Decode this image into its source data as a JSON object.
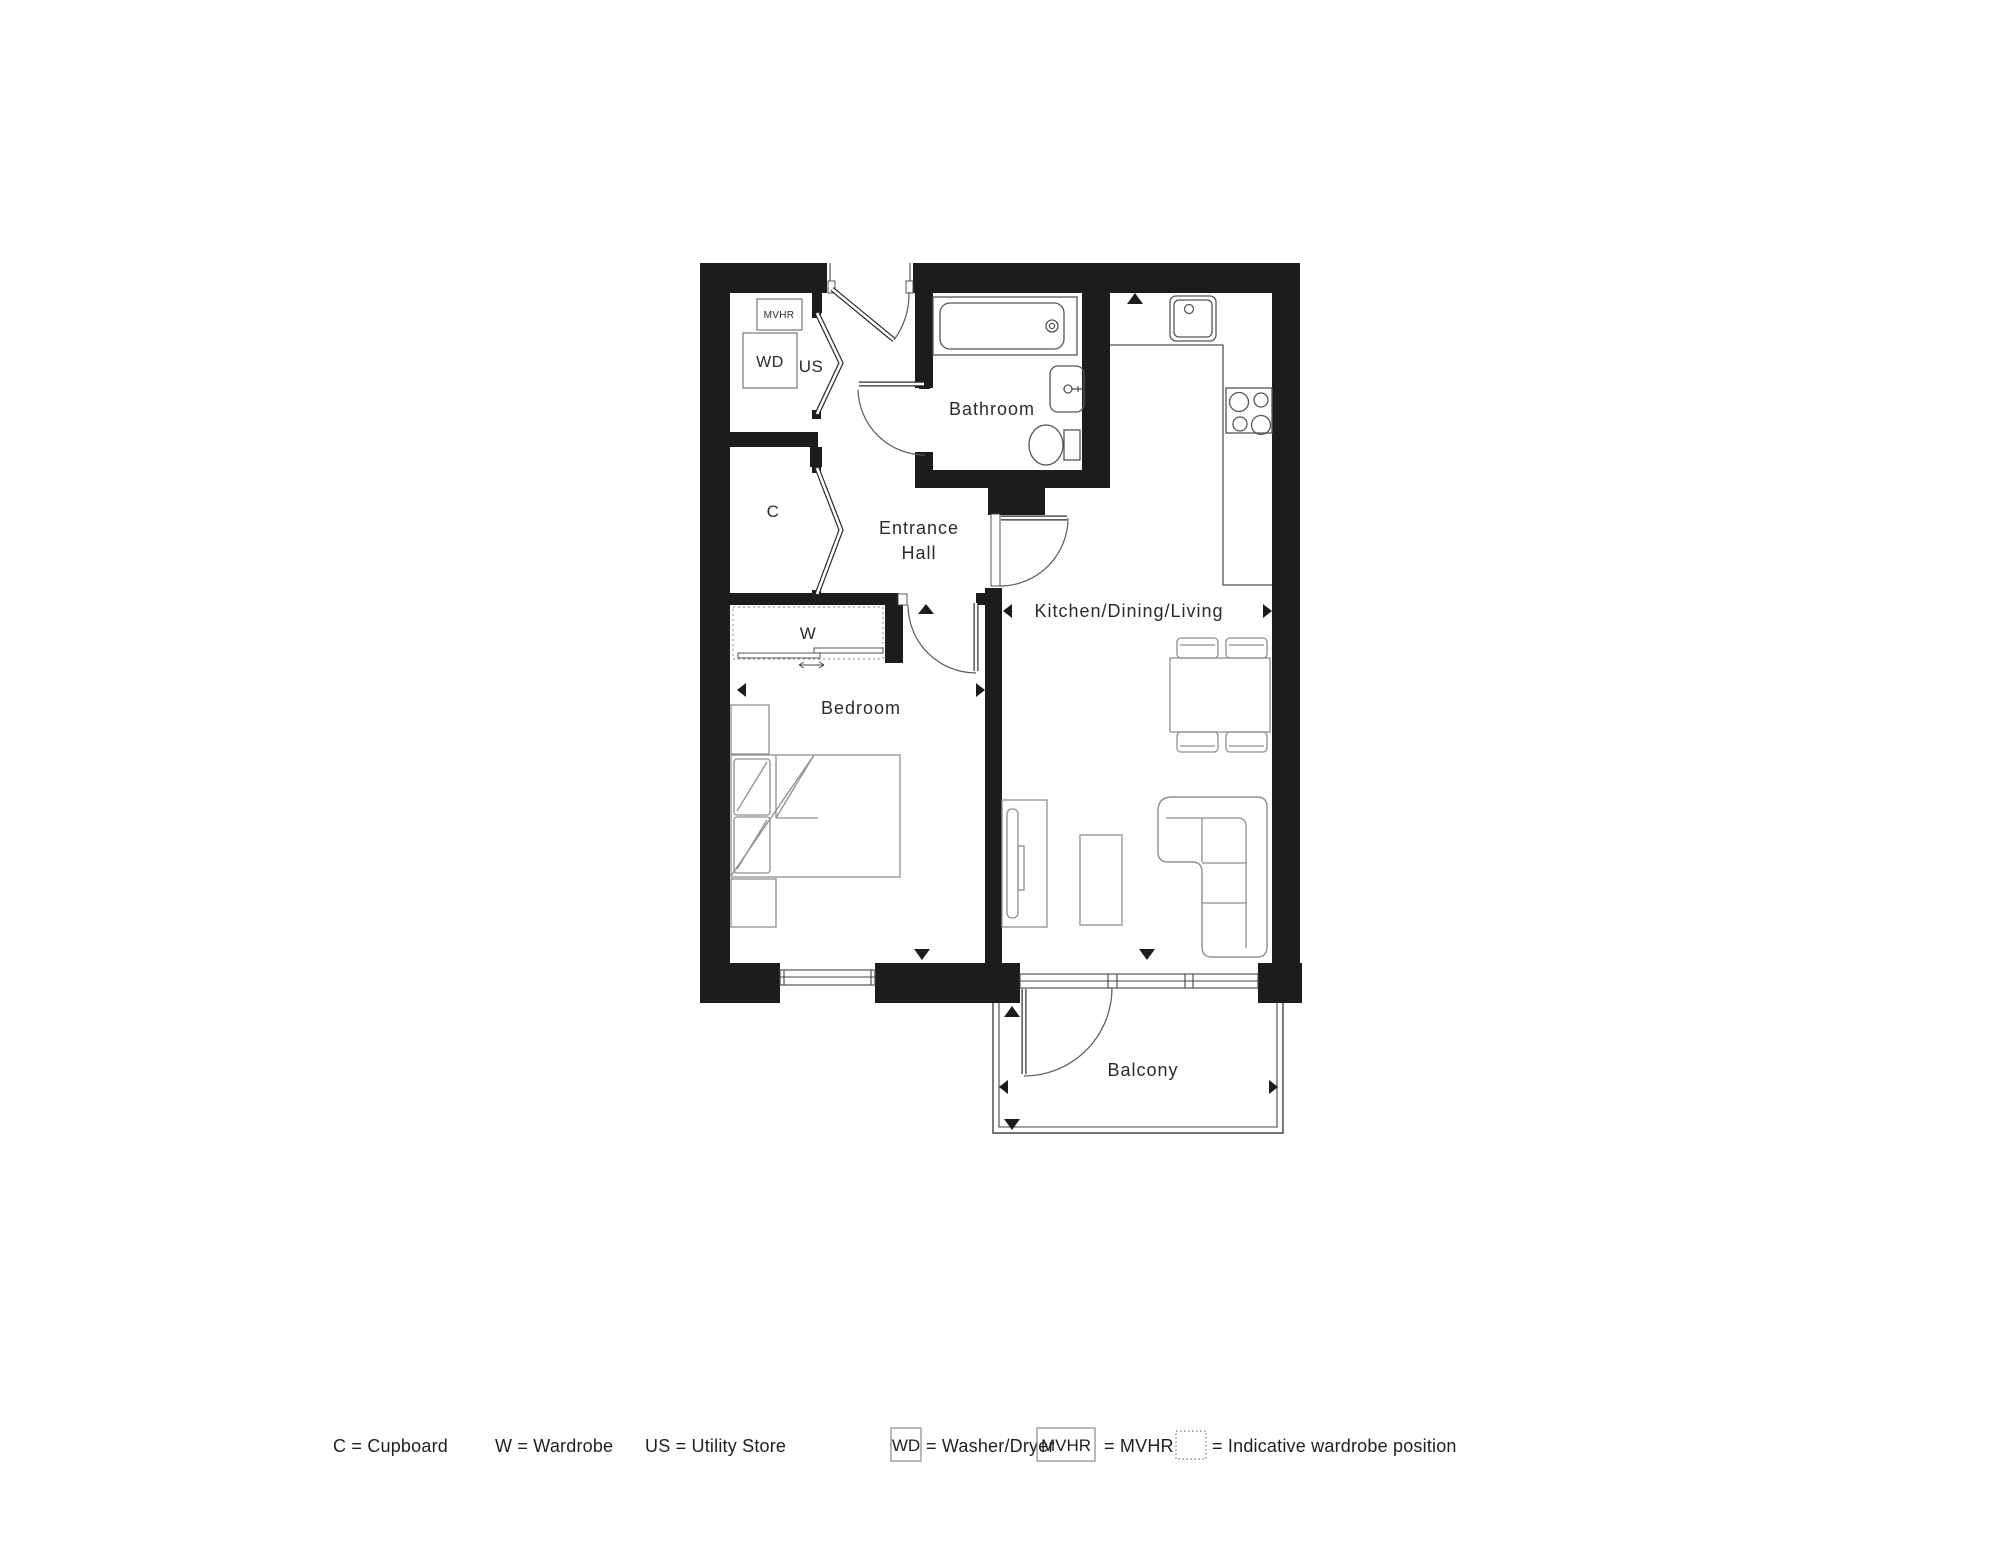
{
  "plan": {
    "rooms": {
      "bathroom": "Bathroom",
      "entrance_line1": "Entrance",
      "entrance_line2": "Hall",
      "kitchen_dining_living": "Kitchen/Dining/Living",
      "bedroom": "Bedroom",
      "balcony": "Balcony"
    },
    "markers": {
      "mvhr": "MVHR",
      "wd": "WD",
      "us": "US",
      "cupboard": "C",
      "wardrobe": "W"
    }
  },
  "legend": {
    "cupboard": "C = Cupboard",
    "wardrobe": "W = Wardrobe",
    "utility_store": "US = Utility Store",
    "washer_dryer_symbol": "WD",
    "washer_dryer_label": "= Washer/Dryer",
    "mvhr_symbol": "MVHR",
    "mvhr_label": "= MVHR",
    "indicative_wardrobe_label": "= Indicative wardrobe position"
  },
  "colors": {
    "wall": "#1c1c1c",
    "fixture_line": "#555555",
    "furniture_line": "#8f8f8f",
    "text": "#2b2b2b",
    "background": "#ffffff"
  }
}
